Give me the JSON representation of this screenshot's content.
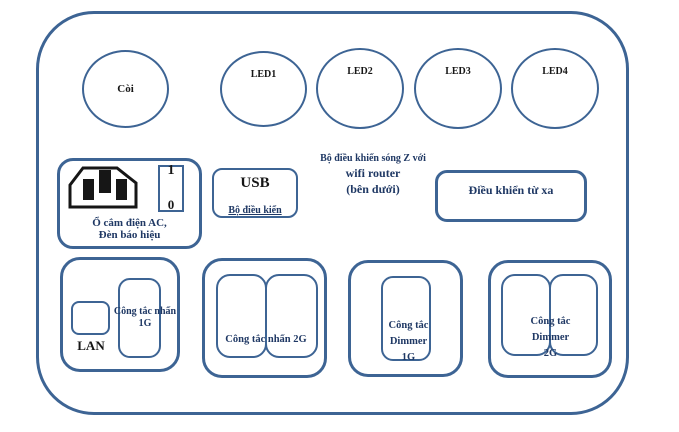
{
  "colors": {
    "border_blue": "#3d6494",
    "text_navy": "#1f3864",
    "text_black": "#161616",
    "background": "#ffffff"
  },
  "panel": {
    "indicators": [
      {
        "label": "Còi"
      },
      {
        "label": "LED1"
      },
      {
        "label": "LED2"
      },
      {
        "label": "LED3"
      },
      {
        "label": "LED4"
      }
    ],
    "power": {
      "caption_line1": "Ổ cắm điện AC,",
      "caption_line2": "Đèn báo hiệu",
      "switch_on_label": "1",
      "switch_off_label": "0",
      "inlet_icon": "ac-inlet-icon"
    },
    "usb": {
      "title": "USB",
      "caption": "Bộ điều kiển"
    },
    "note": {
      "line1": "Bộ điều khiển sóng Z với",
      "line2": "wifi router",
      "line3": "(bên dưới)"
    },
    "remote": {
      "label": "Điều khiển từ xa"
    },
    "modules": {
      "m1": {
        "port": "LAN",
        "line1": "Công tắc nhấn",
        "line2": "1G"
      },
      "m2": {
        "label": "Công tắc nhấn 2G"
      },
      "m3": {
        "line1": "Công tắc",
        "line2": "Dimmer",
        "line3": "1G"
      },
      "m4": {
        "line1": "Công tắc",
        "line2": "Dimmer",
        "line3": "2G"
      }
    }
  }
}
